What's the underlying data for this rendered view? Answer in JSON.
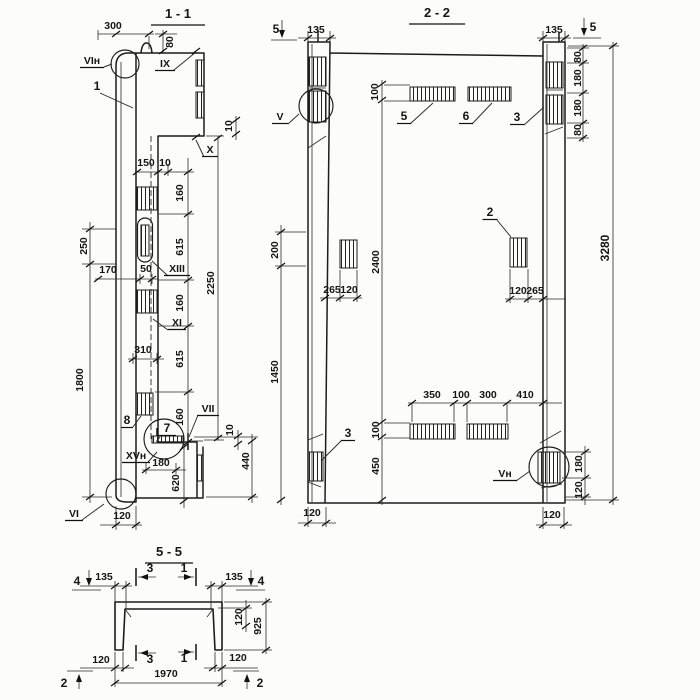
{
  "drawing": {
    "colors": {
      "ink": "#1c1c1c",
      "paper": "#fcfcfa"
    }
  },
  "sections": [
    {
      "key": "s11",
      "name": "section-1-1",
      "texts": [
        {
          "t": "1 - 1",
          "x": 178,
          "y": 18,
          "fs": 13,
          "u": 54,
          "uy": 7,
          "n": "section-title"
        },
        {
          "t": "300",
          "x": 113,
          "y": 29
        },
        {
          "t": "80",
          "x": 173,
          "y": 42,
          "r": -90
        },
        {
          "t": "VIн",
          "x": 92,
          "y": 64,
          "u": 24,
          "n": "view-label"
        },
        {
          "t": "IX",
          "x": 165,
          "y": 67,
          "u": 20,
          "n": "view-label"
        },
        {
          "t": "1",
          "x": 97,
          "y": 90,
          "fs": 12,
          "n": "position-label"
        },
        {
          "t": "10",
          "x": 232,
          "y": 126,
          "r": -90
        },
        {
          "t": "X",
          "x": 210,
          "y": 153,
          "u": 16,
          "n": "view-label"
        },
        {
          "t": "150",
          "x": 146,
          "y": 166
        },
        {
          "t": "10",
          "x": 165,
          "y": 166
        },
        {
          "t": "160",
          "x": 183,
          "y": 193,
          "r": -90
        },
        {
          "t": "615",
          "x": 183,
          "y": 247,
          "r": -90
        },
        {
          "t": "160",
          "x": 183,
          "y": 303,
          "r": -90
        },
        {
          "t": "615",
          "x": 183,
          "y": 359,
          "r": -90
        },
        {
          "t": "160",
          "x": 183,
          "y": 417,
          "r": -90
        },
        {
          "t": "2250",
          "x": 214,
          "y": 283,
          "r": -90
        },
        {
          "t": "250",
          "x": 87,
          "y": 246,
          "r": -90
        },
        {
          "t": "170",
          "x": 108,
          "y": 273
        },
        {
          "t": "50",
          "x": 146,
          "y": 272
        },
        {
          "t": "XIII",
          "x": 177,
          "y": 272,
          "u": 26,
          "n": "view-label"
        },
        {
          "t": "XI",
          "x": 177,
          "y": 326,
          "u": 18,
          "n": "view-label"
        },
        {
          "t": "310",
          "x": 143,
          "y": 353
        },
        {
          "t": "1800",
          "x": 83,
          "y": 380,
          "r": -90
        },
        {
          "t": "8",
          "x": 127,
          "y": 424,
          "fs": 12,
          "u": 12,
          "n": "position-label"
        },
        {
          "t": "7",
          "x": 167,
          "y": 432,
          "fs": 12,
          "u": 18,
          "n": "position-label"
        },
        {
          "t": "VII",
          "x": 208,
          "y": 412,
          "u": 22,
          "n": "view-label"
        },
        {
          "t": "10",
          "x": 233,
          "y": 430,
          "r": -90
        },
        {
          "t": "XVн",
          "x": 136,
          "y": 459,
          "u": 28,
          "n": "view-label"
        },
        {
          "t": "180",
          "x": 161,
          "y": 466
        },
        {
          "t": "620",
          "x": 179,
          "y": 483,
          "r": -90
        },
        {
          "t": "440",
          "x": 249,
          "y": 461,
          "r": -90
        },
        {
          "t": "VI",
          "x": 74,
          "y": 517,
          "u": 18,
          "n": "view-label"
        },
        {
          "t": "120",
          "x": 122,
          "y": 519
        }
      ]
    },
    {
      "key": "s22",
      "name": "section-2-2",
      "texts": [
        {
          "t": "2 - 2",
          "x": 437,
          "y": 17,
          "fs": 13,
          "u": 56,
          "uy": 7,
          "n": "section-title"
        },
        {
          "t": "5",
          "x": 276,
          "y": 33,
          "fs": 12,
          "n": "cut-label"
        },
        {
          "t": "135",
          "x": 316,
          "y": 33
        },
        {
          "t": "135",
          "x": 554,
          "y": 33
        },
        {
          "t": "5",
          "x": 593,
          "y": 31,
          "fs": 12,
          "n": "cut-label"
        },
        {
          "t": "80",
          "x": 581,
          "y": 57,
          "r": -90
        },
        {
          "t": "180",
          "x": 581,
          "y": 78,
          "r": -90
        },
        {
          "t": "180",
          "x": 581,
          "y": 108,
          "r": -90
        },
        {
          "t": "80",
          "x": 581,
          "y": 130,
          "r": -90
        },
        {
          "t": "3280",
          "x": 609,
          "y": 248,
          "r": -90,
          "fs": 12
        },
        {
          "t": "V",
          "x": 280,
          "y": 120,
          "u": 16,
          "n": "view-label"
        },
        {
          "t": "100",
          "x": 378,
          "y": 92,
          "r": -90
        },
        {
          "t": "5",
          "x": 404,
          "y": 120,
          "fs": 12,
          "u": 14,
          "n": "position-label"
        },
        {
          "t": "6",
          "x": 466,
          "y": 120,
          "fs": 12,
          "u": 14,
          "n": "position-label"
        },
        {
          "t": "3",
          "x": 517,
          "y": 121,
          "fs": 12,
          "u": 14,
          "n": "position-label"
        },
        {
          "t": "2",
          "x": 490,
          "y": 216,
          "fs": 12,
          "u": 15,
          "n": "position-label"
        },
        {
          "t": "200",
          "x": 278,
          "y": 250,
          "r": -90
        },
        {
          "t": "2400",
          "x": 379,
          "y": 262,
          "r": -90
        },
        {
          "t": "265",
          "x": 332,
          "y": 293
        },
        {
          "t": "120",
          "x": 349,
          "y": 293
        },
        {
          "t": "120",
          "x": 518,
          "y": 294
        },
        {
          "t": "265",
          "x": 535,
          "y": 294
        },
        {
          "t": "1450",
          "x": 278,
          "y": 372,
          "r": -90
        },
        {
          "t": "3",
          "x": 348,
          "y": 437,
          "fs": 12,
          "u": 14,
          "n": "position-label"
        },
        {
          "t": "350",
          "x": 432,
          "y": 398
        },
        {
          "t": "100",
          "x": 461,
          "y": 398
        },
        {
          "t": "300",
          "x": 488,
          "y": 398
        },
        {
          "t": "410",
          "x": 525,
          "y": 398
        },
        {
          "t": "100",
          "x": 379,
          "y": 430,
          "r": -90
        },
        {
          "t": "450",
          "x": 379,
          "y": 466,
          "r": -90
        },
        {
          "t": "Vн",
          "x": 505,
          "y": 477,
          "u": 24,
          "n": "view-label"
        },
        {
          "t": "180",
          "x": 582,
          "y": 464,
          "r": -90
        },
        {
          "t": "120",
          "x": 582,
          "y": 490,
          "r": -90
        },
        {
          "t": "120",
          "x": 312,
          "y": 516
        },
        {
          "t": "120",
          "x": 552,
          "y": 518
        }
      ]
    },
    {
      "key": "s55",
      "name": "section-5-5",
      "texts": [
        {
          "t": "5 - 5",
          "x": 169,
          "y": 556,
          "fs": 13,
          "u": 48,
          "uy": 7,
          "n": "section-title"
        },
        {
          "t": "4",
          "x": 77,
          "y": 585,
          "fs": 12,
          "n": "cut-label"
        },
        {
          "t": "135",
          "x": 104,
          "y": 580
        },
        {
          "t": "3",
          "x": 150,
          "y": 572,
          "fs": 12,
          "n": "cut-label"
        },
        {
          "t": "1",
          "x": 184,
          "y": 572,
          "fs": 12,
          "n": "cut-label"
        },
        {
          "t": "135",
          "x": 234,
          "y": 580
        },
        {
          "t": "4",
          "x": 261,
          "y": 585,
          "fs": 12,
          "n": "cut-label"
        },
        {
          "t": "120",
          "x": 242,
          "y": 617,
          "r": -90
        },
        {
          "t": "925",
          "x": 261,
          "y": 626,
          "r": -90
        },
        {
          "t": "120",
          "x": 101,
          "y": 663
        },
        {
          "t": "3",
          "x": 150,
          "y": 663,
          "fs": 12,
          "n": "cut-label"
        },
        {
          "t": "1",
          "x": 184,
          "y": 662,
          "fs": 12,
          "n": "cut-label"
        },
        {
          "t": "120",
          "x": 238,
          "y": 661
        },
        {
          "t": "1970",
          "x": 166,
          "y": 677
        },
        {
          "t": "2",
          "x": 64,
          "y": 687,
          "fs": 12,
          "n": "cut-label"
        },
        {
          "t": "2",
          "x": 260,
          "y": 687,
          "fs": 12,
          "n": "cut-label"
        }
      ]
    }
  ]
}
